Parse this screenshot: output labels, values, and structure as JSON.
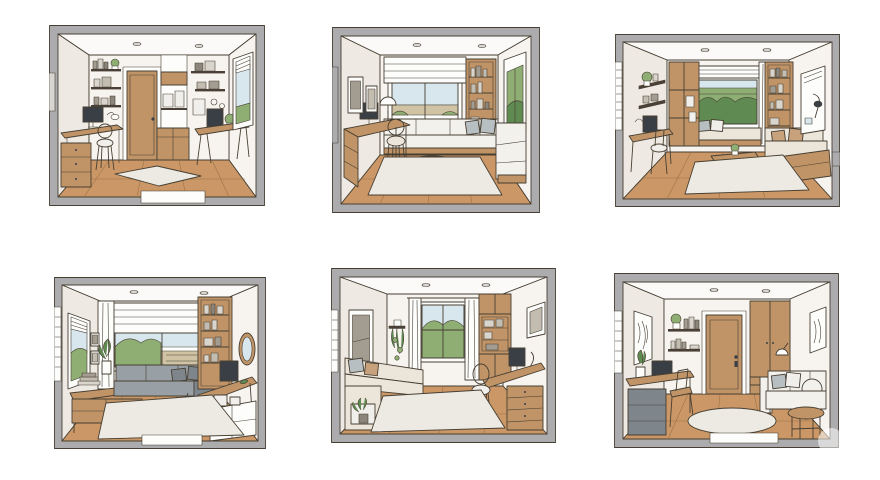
{
  "page": {
    "title": "Interior design concept grid",
    "background": "#ffffff",
    "grid": {
      "rows": 2,
      "cols": 3,
      "panel_count": 6
    }
  },
  "palette": {
    "frame": "#acacae",
    "frameEdge": "#6f6f71",
    "wall": "#f7f4ef",
    "wallShade": "#eeeae3",
    "ceiling": "#fbfaf8",
    "floor": "#cb9766",
    "floorLine": "#9c7248",
    "wood": "#c09467",
    "woodDark": "#a87c4f",
    "shelfDark": "#4a4038",
    "screen": "#3a3f46",
    "green": "#8fae74",
    "greenDark": "#5f8a52",
    "sky": "#d8e7ee",
    "field": "#cfc3a4",
    "rug": "#eceae3",
    "sofaWhite": "#f3f1ec",
    "sofaGray": "#99a0a5",
    "sofaGrayDark": "#7e868c",
    "sofaBeige": "#ece6da",
    "cushionGray": "#b8bfc3",
    "cushionTan": "#c8a27c"
  },
  "panels": [
    {
      "id": "room-1",
      "description": "Home office with central wooden door, wall shelves, two computer desks, drawer cabinet, diamond rug and corner window"
    },
    {
      "id": "room-2",
      "description": "Living room with white sectional sofa, round coffee table, roman-shade window, tall bookshelf, corner desk with lamp and monitor"
    },
    {
      "id": "room-3",
      "description": "Studio room with wardrobe, small desk, curtained garden window with window seat, bookshelf and beige sofa with storage ottoman"
    },
    {
      "id": "room-4",
      "description": "Living room with gray sectional sofa, wide blinded window, curtain, media console, bookshelf desk nook, oval mirror and white sideboard"
    },
    {
      "id": "room-5",
      "description": "Living room with beige L-sofa and planter arm, round coffee table, curtained window, hanging plant, tall cabinet and desk with drawers"
    },
    {
      "id": "room-6",
      "description": "Bedroom-office with wooden door, double wardrobe, wall sconce, white sofa with bolster, round side table, oval rug, dark drawer desk and shelves"
    }
  ]
}
